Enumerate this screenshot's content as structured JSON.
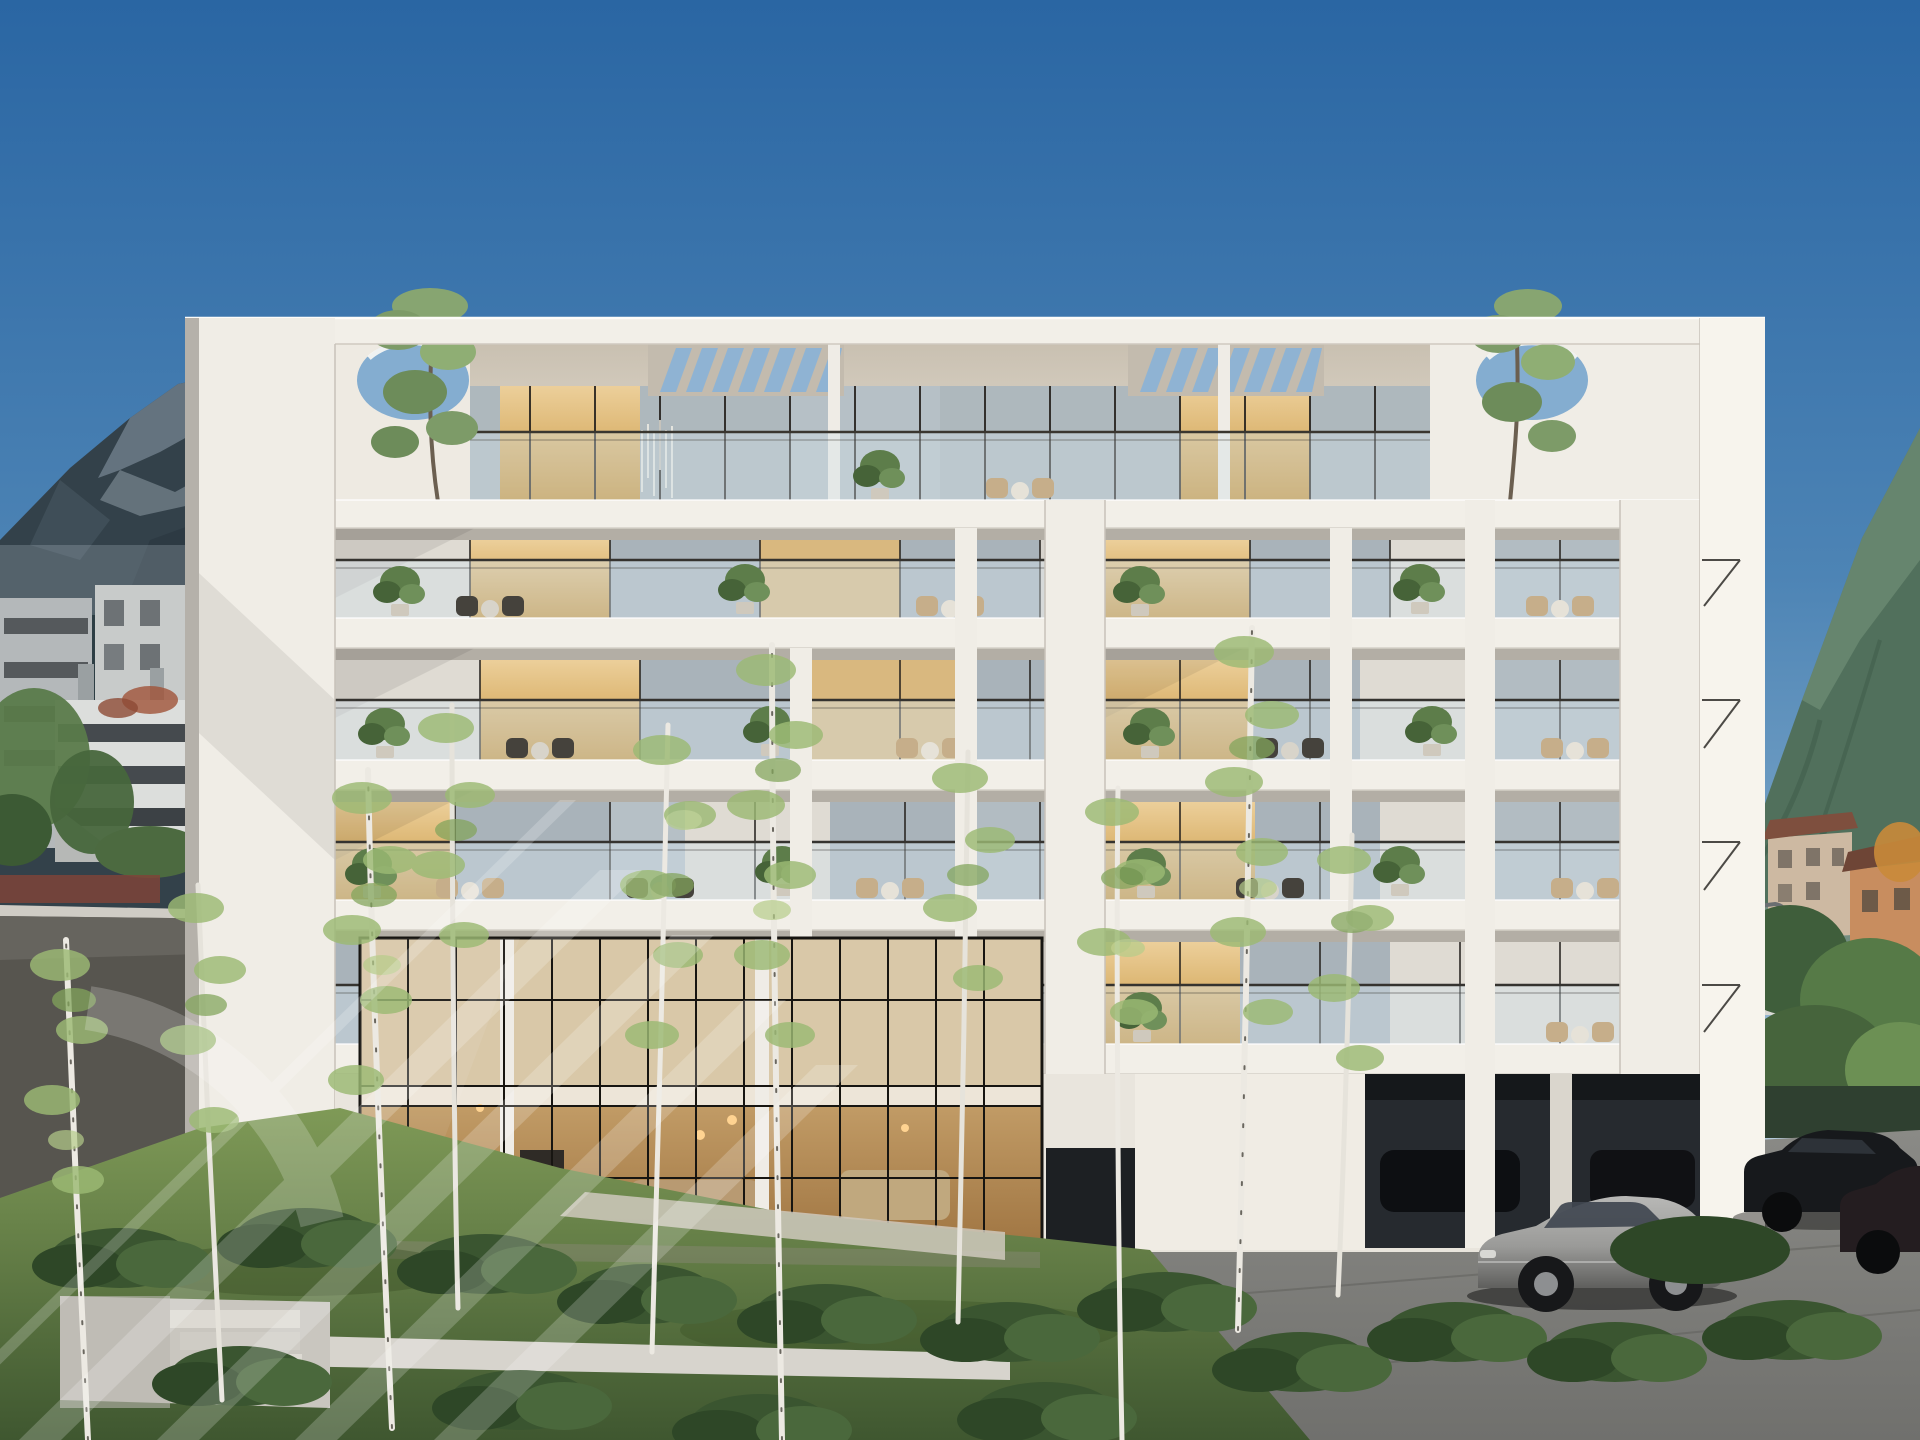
{
  "meta": {
    "domain": "natural-image",
    "description": "Sunny 3D architectural rendering of a modern six-storey white apartment building with recessed glass balconies, rooftop pergola slats and circular roof openings with trees, set in an alpine valley with mountains, background town, birch trees, lawns, cobblestone parking and parked cars.",
    "watermark_note": "large semi-transparent diagonal-stripe logo watermark in the lower-left quadrant"
  },
  "palette": {
    "sky_top": "#2a66a3",
    "sky_mid": "#4d84b5",
    "sky_low": "#7ea8c9",
    "sky_horizon": "#b6cbdb",
    "mountain_left_dark": "#33414a",
    "mountain_left_rock": "#6d7d88",
    "mountain_right": "#51705c",
    "facade_base": "#d8d4cc",
    "facade_pier": "#f0ede6",
    "facade_sunlit": "#f7f4ed",
    "slab": "#f2efe8",
    "glass_rail": "#d3e2eb",
    "interior_warm": "#eccf9a",
    "interior_warm_deep": "#c8963f",
    "interior_cool": "#a9b3ba",
    "curtain": "#dfdbd3",
    "mullion": "#26221e",
    "lawn_light": "#7f9a57",
    "lawn_dark": "#3f5730",
    "bush_green": "#3a5530",
    "birch_foliage": "#9cba74",
    "road": "#57554f",
    "pavement": "#70706d",
    "undercroft": "#262a2f",
    "car_silver": "#9a9a98",
    "car_dark": "#17191c",
    "watermark_color": "#ffffff",
    "watermark_opacity": "0.2"
  },
  "scene": {
    "sky": {
      "condition": "clear gradient sky"
    },
    "mountains": {
      "left": "rocky forested peak",
      "right": "green forested slope"
    },
    "background_left": [
      "grey apartment block",
      "white parking structure with dark bands",
      "green trees",
      "red-brown fence",
      "asphalt road"
    ],
    "background_right": [
      "beige apartment blocks with red roofs",
      "street lamp",
      "large green trees",
      "dark hedge"
    ],
    "building": {
      "storeys": 6,
      "facade": "white concrete grid, recessed balconies",
      "balconies": "frameless glass balustrades with plants and outdoor furniture",
      "penthouse": {
        "pergola_groups": 2,
        "slats_per_group": 7,
        "oculi": 2,
        "oculus_trees": 2
      },
      "ground_floor": "double-height glazed lobby with black steel grid and warm interior",
      "parking": "dark undercroft parking at right with black cars"
    },
    "foreground": {
      "birch_trees": 10,
      "bushes": true,
      "lawn": true,
      "concrete_steps": "lower left",
      "pavement": "cobblestone at right",
      "path": "pale path in front of lobby"
    },
    "vehicles": [
      {
        "type": "sedan",
        "color_name": "silver-grey"
      },
      {
        "type": "suv",
        "color_name": "black"
      },
      {
        "type": "estate",
        "color_name": "dark red-black"
      },
      {
        "type": "undercroft cars",
        "color_name": "black"
      }
    ],
    "watermark": {
      "present": true,
      "stripes": 5,
      "arcs": 1
    }
  }
}
